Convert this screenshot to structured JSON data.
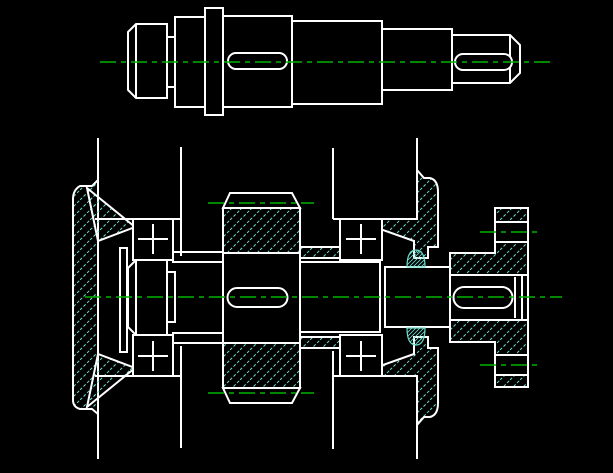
{
  "canvas": {
    "width": 613,
    "height": 473
  },
  "colors": {
    "background": "#000000",
    "outline": "#ffffff",
    "centerline": "#00b400",
    "hatch": "#6fdecd"
  },
  "drawing": {
    "type": "2d-orthographic-cad-drawing",
    "views": [
      {
        "id": "front-view",
        "label": "shaft elevation with keyways"
      },
      {
        "id": "section-view",
        "label": "assembly section: housing, end caps, bearings, gear, seals, flange coupling"
      }
    ]
  },
  "top_view_entities": [
    {
      "name": "shaft-neck",
      "role": "solid",
      "d": "M167 37 H175 V87 H167 Z"
    },
    {
      "name": "shaft-left-cylinder",
      "role": "solid",
      "d": "M128 32 L136 24 H167 V98 H136 L128 90 Z"
    },
    {
      "name": "shaft-cylinder-2",
      "role": "solid",
      "d": "M175 17 H205 V107 H175 Z"
    },
    {
      "name": "shaft-cylinder-4",
      "role": "solid",
      "d": "M292 21 H382 V104 H292 Z"
    },
    {
      "name": "shaft-cylinder-3",
      "role": "solid",
      "d": "M223 16 H292 V107 H223 Z"
    },
    {
      "name": "shaft-cylinder-5",
      "role": "solid",
      "d": "M382 29 H452 V90 H382 Z"
    },
    {
      "name": "shaft-end-cylinder",
      "role": "solid",
      "d": "M452 35 H510 L520 45 V73 L510 83 H452 Z"
    },
    {
      "name": "shaft-collar",
      "role": "solid",
      "d": "M205 8 H223 V115 H205 Z"
    },
    {
      "name": "left-chamfer-line",
      "role": "line",
      "d": "M136 24 V98"
    },
    {
      "name": "end-chamfer-line",
      "role": "line",
      "d": "M510 35 V83"
    },
    {
      "name": "keyway-slot-middle",
      "role": "solid",
      "d": "M236 53 H279 A8 8 0 0 1 287 61 A8 8 0 0 1 279 69 H236 A8 8 0 0 1 228 61 A8 8 0 0 1 236 53 Z"
    },
    {
      "name": "keyway-slot-end",
      "role": "solid",
      "d": "M463 54 H504 A8 8 0 0 1 512 62 A8 8 0 0 1 504 70 H463 A8 8 0 0 1 455 62 A8 8 0 0 1 463 54 Z"
    },
    {
      "name": "shaft-centerline",
      "role": "centerline",
      "d": "M100 62 H552"
    }
  ],
  "bottom_view_entities": [
    {
      "name": "cap-left-plate",
      "role": "hatched",
      "d": "M98 180 L92 186 H80 Q73 190 73 199 V400 Q73 407 80 409 H92 L98 414 Z"
    },
    {
      "name": "cap-left-cone-upper",
      "role": "hatched",
      "d": "M87 188 L135 227 L98 241 Z"
    },
    {
      "name": "cap-left-cone-lower",
      "role": "hatched",
      "d": "M87 407 L135 368 L98 354 Z"
    },
    {
      "name": "gear-rim-upper",
      "role": "hatched",
      "d": "M223 208 H300 V253 H223 Z"
    },
    {
      "name": "gear-rim-lower",
      "role": "hatched",
      "d": "M223 343 H300 V388 H223 Z"
    },
    {
      "name": "spacer-sleeve-upper",
      "role": "hatched",
      "d": "M300 247 H340 V258 H300 Z"
    },
    {
      "name": "spacer-sleeve-lower",
      "role": "hatched",
      "d": "M300 337 H340 V348 H300 Z"
    },
    {
      "name": "cap-right-upper",
      "role": "hatched",
      "d": "M417 170 L424 178 H430 Q438 180 438 192 V247 H428 V258 H414 V241 L380 229 V219 H417 Z"
    },
    {
      "name": "cap-right-lower",
      "role": "hatched",
      "d": "M417 425 L424 417 H430 Q438 415 438 403 V348 H428 V337 H414 V354 L380 366 V376 H417 Z"
    },
    {
      "name": "flange-coupling-body",
      "role": "hatched",
      "d": "M450 253 H495 V208 H528 V387 H495 V342 H450 Z"
    },
    {
      "name": "flange-bore",
      "role": "solid",
      "d": "M450 275 H528 V320 H450 Z"
    },
    {
      "name": "flange-bolt-hole-upper",
      "role": "solid",
      "d": "M495 222 H528 V242 H495 Z"
    },
    {
      "name": "flange-bolt-hole-lower",
      "role": "solid",
      "d": "M495 355 H528 V375 H495 Z"
    },
    {
      "name": "retainer-plate",
      "role": "solid",
      "d": "M120 248 H127 V352 H120 Z"
    },
    {
      "name": "shaft-end-left-section",
      "role": "solid",
      "d": "M128 268 L136 260 H167 V335 H136 L128 327 Z"
    },
    {
      "name": "shaft-neck-section",
      "role": "solid",
      "d": "M167 272 H175 V322 H167 Z"
    },
    {
      "name": "sleeve-left-upper",
      "role": "solid",
      "d": "M173 252 H223 V262 H173 Z"
    },
    {
      "name": "sleeve-left-lower",
      "role": "solid",
      "d": "M173 333 H223 V343 H173 Z"
    },
    {
      "name": "shaft-mid-section",
      "role": "solid",
      "d": "M300 262 H380 V332 H300 Z"
    },
    {
      "name": "shaft-seal-section",
      "role": "solid",
      "d": "M385 267 H450 V327 H385 Z"
    },
    {
      "name": "shaft-end-right-section",
      "role": "solid",
      "d": "M450 275 H522 V320 H450 Z"
    },
    {
      "name": "bearing-left-upper",
      "role": "solid",
      "d": "M133 219 H173 V260 H133 Z"
    },
    {
      "name": "bearing-left-lower",
      "role": "solid",
      "d": "M133 335 H173 V376 H133 Z"
    },
    {
      "name": "bearing-right-upper",
      "role": "solid",
      "d": "M340 219 H382 V260 H340 Z"
    },
    {
      "name": "bearing-right-lower",
      "role": "solid",
      "d": "M340 335 H382 V376 H340 Z"
    },
    {
      "name": "gear-crown-upper",
      "role": "solid",
      "d": "M223 208 L230 193 H292 L300 208 Z"
    },
    {
      "name": "gear-crown-lower",
      "role": "solid",
      "d": "M223 388 L230 403 H292 L300 388 Z"
    },
    {
      "name": "keyway-slot-gear",
      "role": "solid",
      "d": "M237 288 H278 A9.5 9.5 0 0 1 278 307 H237 A9.5 9.5 0 0 1 237 288 Z"
    },
    {
      "name": "keyway-slot-coupling",
      "role": "solid",
      "d": "M464 287 H502 A10.5 10.5 0 0 1 502 308 H464 A10.5 10.5 0 0 1 464 287 Z"
    },
    {
      "name": "housing-wall-top-1",
      "role": "line",
      "d": "M98 138 V180"
    },
    {
      "name": "housing-wall-top-2",
      "role": "line",
      "d": "M181 147 V256"
    },
    {
      "name": "housing-wall-top-3",
      "role": "line",
      "d": "M333 148 V219"
    },
    {
      "name": "housing-wall-top-4",
      "role": "line",
      "d": "M417 138 V170"
    },
    {
      "name": "housing-wall-bottom-1",
      "role": "line",
      "d": "M98 413 V459"
    },
    {
      "name": "housing-wall-bottom-2",
      "role": "line",
      "d": "M181 346 V448"
    },
    {
      "name": "housing-wall-bottom-3",
      "role": "line",
      "d": "M333 351 V449"
    },
    {
      "name": "housing-wall-bottom-4",
      "role": "line",
      "d": "M417 425 V459"
    },
    {
      "name": "bore-line-upper-left",
      "role": "line",
      "d": "M95 219 H181"
    },
    {
      "name": "bore-line-lower-left",
      "role": "line",
      "d": "M95 376 H181"
    },
    {
      "name": "bore-line-upper-right",
      "role": "line",
      "d": "M333 219 H417"
    },
    {
      "name": "bore-line-lower-right",
      "role": "line",
      "d": "M333 376 H417"
    },
    {
      "name": "shaft-line-upper-left",
      "role": "line",
      "d": "M175 262 H223"
    },
    {
      "name": "shaft-line-lower-left",
      "role": "line",
      "d": "M175 333 H223"
    },
    {
      "name": "gear-face-left",
      "role": "line",
      "d": "M223 253 V343"
    },
    {
      "name": "gear-face-right",
      "role": "line",
      "d": "M300 253 V343"
    },
    {
      "name": "shaft-end-left-chamfer",
      "role": "line",
      "d": "M136 260 V335"
    },
    {
      "name": "shaft-end-right-chamfer",
      "role": "line",
      "d": "M515 277 V318"
    },
    {
      "name": "bearing-left-upper-cross-h",
      "role": "line",
      "d": "M138 239 H168"
    },
    {
      "name": "bearing-left-upper-cross-v",
      "role": "line",
      "d": "M153 224 V254"
    },
    {
      "name": "bearing-left-lower-cross-h",
      "role": "line",
      "d": "M138 356 H168"
    },
    {
      "name": "bearing-left-lower-cross-v",
      "role": "line",
      "d": "M153 341 V371"
    },
    {
      "name": "bearing-right-upper-cross-h",
      "role": "line",
      "d": "M346 239 H376"
    },
    {
      "name": "bearing-right-upper-cross-v",
      "role": "line",
      "d": "M361 224 V254"
    },
    {
      "name": "bearing-right-lower-cross-h",
      "role": "line",
      "d": "M346 356 H376"
    },
    {
      "name": "bearing-right-lower-cross-v",
      "role": "line",
      "d": "M361 341 V371"
    },
    {
      "name": "seal-ring-upper",
      "role": "seal",
      "d": "M407 267 Q407 250 416 250 Q425 250 425 267 Z"
    },
    {
      "name": "seal-ring-lower",
      "role": "seal",
      "d": "M407 328 Q407 345 416 345 Q425 345 425 328 Z"
    },
    {
      "name": "main-centerline",
      "role": "centerline",
      "d": "M85 297 H562"
    },
    {
      "name": "gear-pitch-line-upper",
      "role": "centerline",
      "d": "M208 203 H314"
    },
    {
      "name": "gear-pitch-line-lower",
      "role": "centerline",
      "d": "M208 393 H314"
    },
    {
      "name": "bolt-hole-centerline-upper",
      "role": "centerline",
      "d": "M480 232 H542"
    },
    {
      "name": "bolt-hole-centerline-lower",
      "role": "centerline",
      "d": "M480 365 H542"
    }
  ]
}
